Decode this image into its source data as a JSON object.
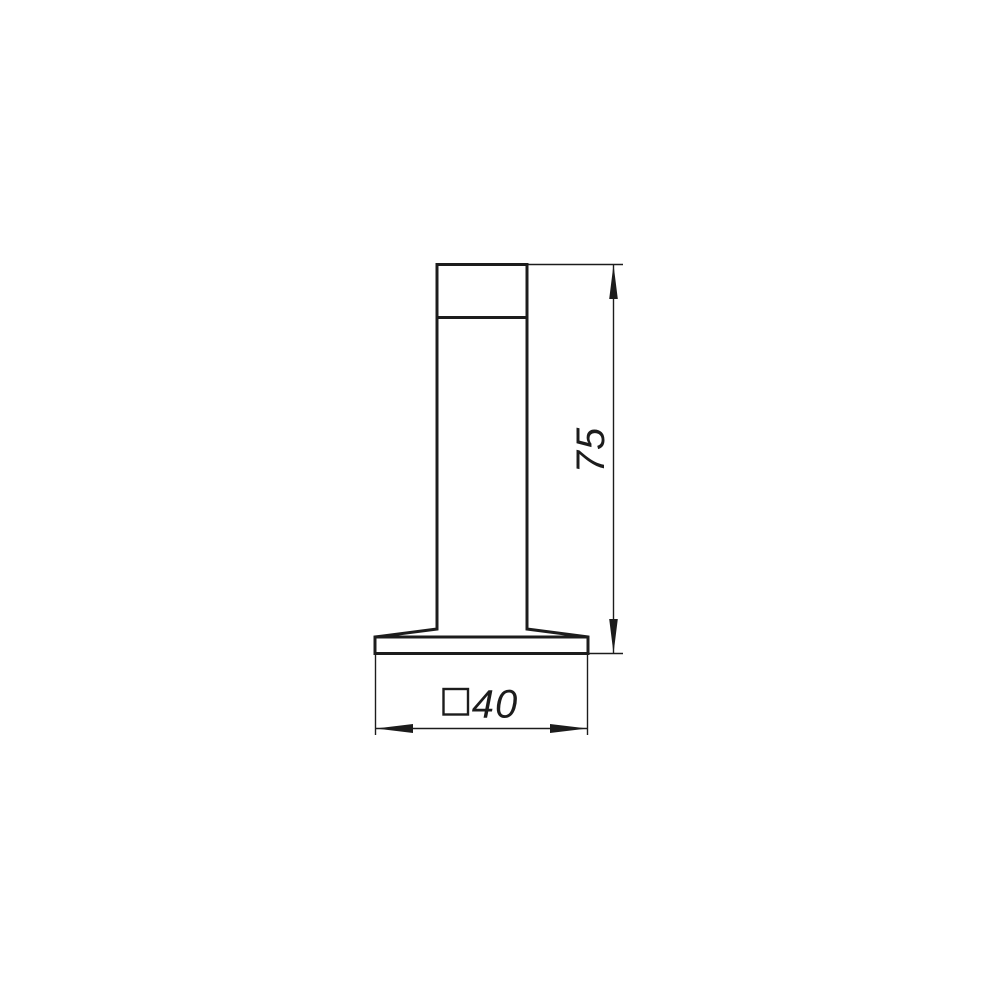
{
  "drawing": {
    "background_color": "#ffffff",
    "line_color": "#1c1c1c",
    "dimensions": {
      "height": {
        "value": "75"
      },
      "width": {
        "value": "40",
        "section_symbol": "□"
      }
    }
  }
}
